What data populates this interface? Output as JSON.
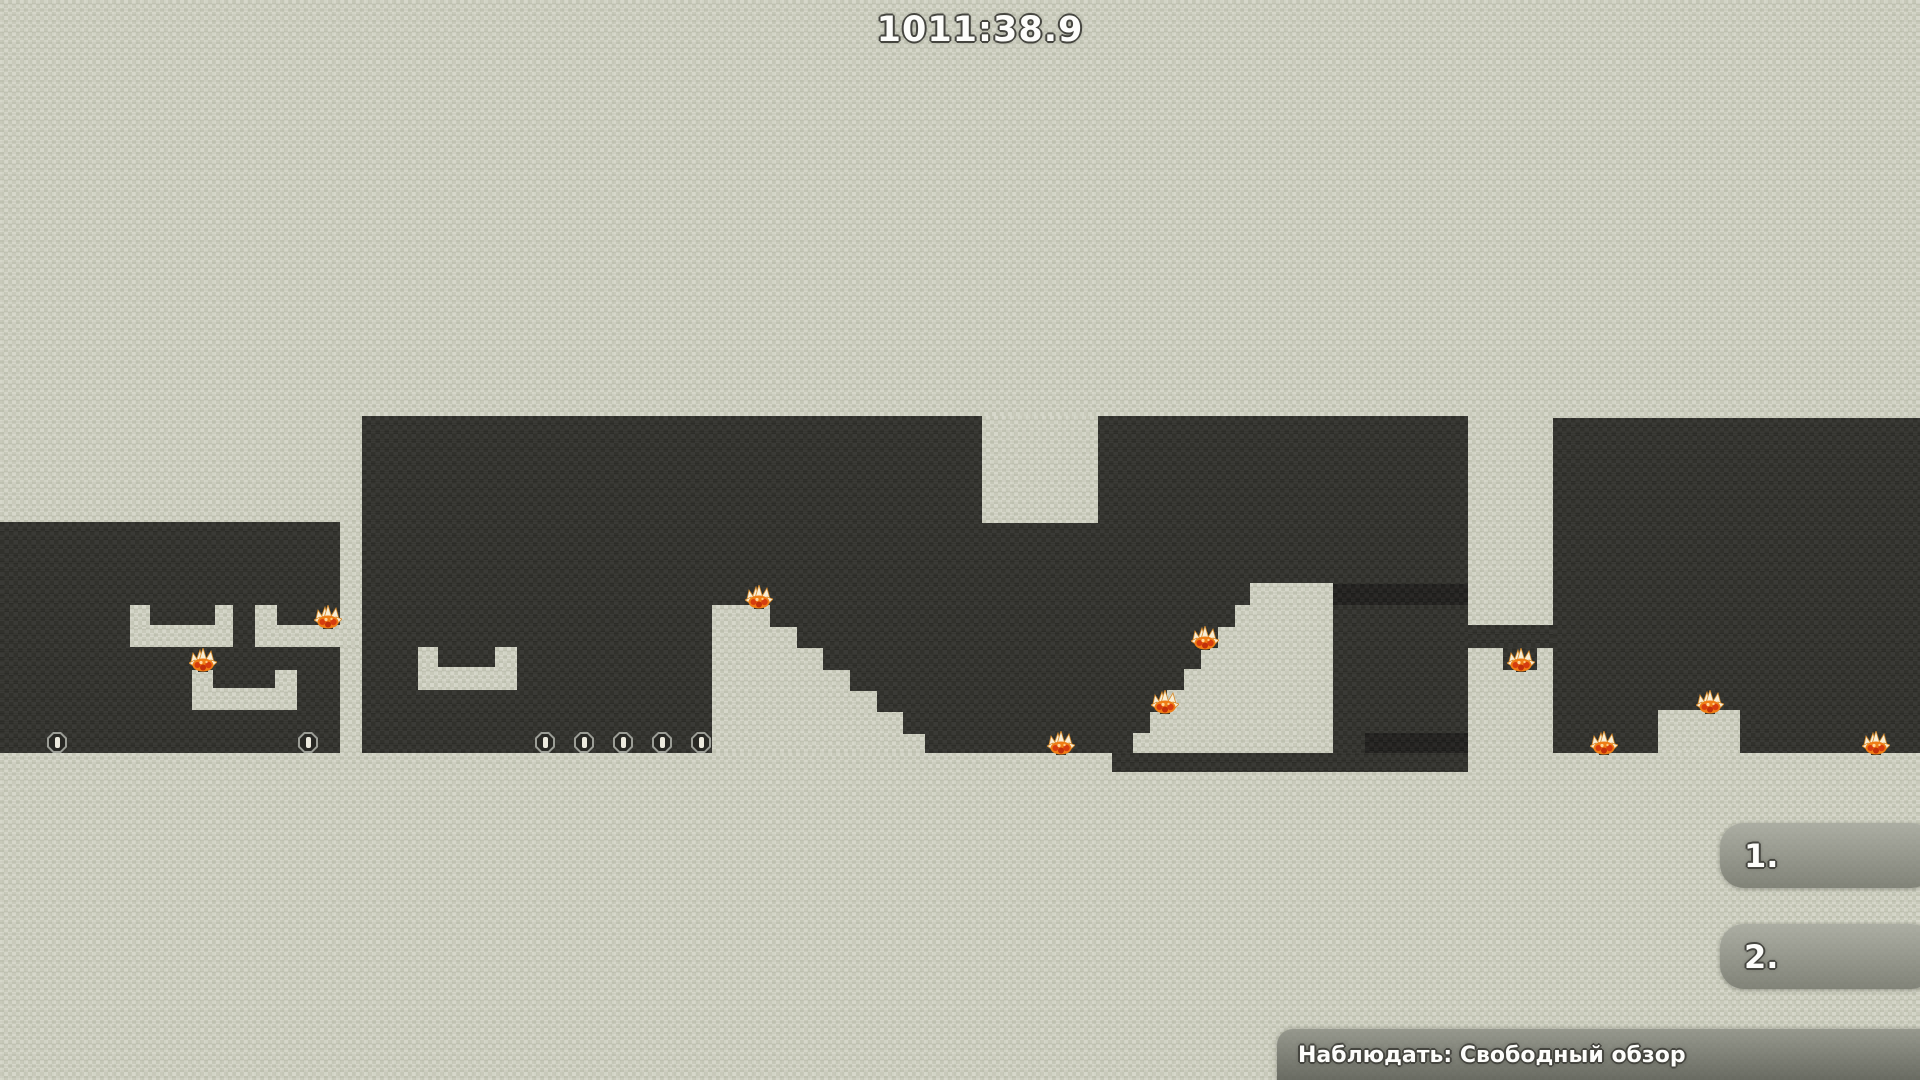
{
  "hud": {
    "timer": "1011:38.9",
    "scoreboard": [
      {
        "rank": "1."
      },
      {
        "rank": "2."
      }
    ],
    "spectate_bar": {
      "label": "Наблюдать: Свободный обзор"
    }
  },
  "colors": {
    "background": "#cdcfc0",
    "cave": "#34342f",
    "cave_deep": "#232220",
    "mine_shell": "#9c9e97",
    "mine_core": "#282824",
    "mine_slit": "#eceade",
    "hud_white": "#fdfdfb",
    "outline": "#45453f",
    "bar_top": "#a6a89ed9",
    "bar_bottom": "#74766cd9",
    "status_top": "#8d8f85d9",
    "status_bottom": "#55574fdd",
    "fire_orange": "#ef7d15",
    "fire_spike": "#f7eed6",
    "fire_red": "#d63c0e"
  },
  "game": {
    "cave_rects": [
      {
        "name": "cave-left",
        "x": 0,
        "y": 522,
        "w": 340,
        "h": 231
      },
      {
        "name": "cave-central",
        "x": 362,
        "y": 416,
        "w": 1106,
        "h": 337
      },
      {
        "name": "cave-right",
        "x": 1553,
        "y": 418,
        "w": 367,
        "h": 335
      },
      {
        "name": "pillar-tunnel",
        "x": 1468,
        "y": 625,
        "w": 85,
        "h": 23
      },
      {
        "name": "underfloor-tunnel",
        "x": 1112,
        "y": 753,
        "w": 356,
        "h": 19
      },
      {
        "name": "pillar-fire-pit",
        "x": 1503,
        "y": 648,
        "w": 34,
        "h": 22
      },
      {
        "name": "deep-band-upper",
        "x": 1333,
        "y": 584,
        "w": 135,
        "h": 21,
        "deep": true
      },
      {
        "name": "deep-band-lower",
        "x": 1365,
        "y": 733,
        "w": 103,
        "h": 20,
        "deep": true
      }
    ],
    "solid_rects": [
      {
        "name": "u1-bar",
        "x": 130,
        "y": 625,
        "w": 103,
        "h": 22
      },
      {
        "name": "u1-leg-l",
        "x": 130,
        "y": 605,
        "w": 20,
        "h": 22
      },
      {
        "name": "u1-leg-r",
        "x": 215,
        "y": 605,
        "w": 18,
        "h": 22
      },
      {
        "name": "u2-bar",
        "x": 255,
        "y": 625,
        "w": 107,
        "h": 22
      },
      {
        "name": "u2-leg-l",
        "x": 255,
        "y": 605,
        "w": 22,
        "h": 22
      },
      {
        "name": "u3-bar",
        "x": 192,
        "y": 688,
        "w": 105,
        "h": 22
      },
      {
        "name": "u3-leg-l",
        "x": 192,
        "y": 670,
        "w": 21,
        "h": 20
      },
      {
        "name": "u3-leg-r",
        "x": 275,
        "y": 670,
        "w": 22,
        "h": 20
      },
      {
        "name": "u4-bar",
        "x": 418,
        "y": 667,
        "w": 99,
        "h": 23
      },
      {
        "name": "u4-leg-l",
        "x": 418,
        "y": 647,
        "w": 20,
        "h": 22
      },
      {
        "name": "u4-leg-r",
        "x": 495,
        "y": 647,
        "w": 22,
        "h": 22
      },
      {
        "name": "ceiling-block",
        "x": 982,
        "y": 416,
        "w": 116,
        "h": 107
      },
      {
        "name": "floor-block",
        "x": 1658,
        "y": 710,
        "w": 82,
        "h": 43
      }
    ],
    "solid_polys": [
      {
        "name": "stepped-hill",
        "points": [
          [
            712,
            605
          ],
          [
            770,
            605
          ],
          [
            770,
            627
          ],
          [
            797,
            627
          ],
          [
            797,
            648
          ],
          [
            823,
            648
          ],
          [
            823,
            670
          ],
          [
            850,
            670
          ],
          [
            850,
            691
          ],
          [
            877,
            691
          ],
          [
            877,
            712
          ],
          [
            903,
            712
          ],
          [
            903,
            734
          ],
          [
            925,
            734
          ],
          [
            925,
            753
          ],
          [
            712,
            753
          ]
        ]
      },
      {
        "name": "stepped-plateau",
        "points": [
          [
            1133,
            753
          ],
          [
            1133,
            733
          ],
          [
            1150,
            733
          ],
          [
            1150,
            712
          ],
          [
            1167,
            712
          ],
          [
            1167,
            690
          ],
          [
            1184,
            690
          ],
          [
            1184,
            669
          ],
          [
            1201,
            669
          ],
          [
            1201,
            648
          ],
          [
            1218,
            648
          ],
          [
            1218,
            627
          ],
          [
            1235,
            627
          ],
          [
            1235,
            605
          ],
          [
            1250,
            605
          ],
          [
            1250,
            583
          ],
          [
            1333,
            583
          ],
          [
            1333,
            753
          ]
        ]
      }
    ],
    "mines": [
      {
        "x": 57,
        "base": 753
      },
      {
        "x": 308,
        "base": 753
      },
      {
        "x": 545,
        "base": 753
      },
      {
        "x": 584,
        "base": 753
      },
      {
        "x": 623,
        "base": 753
      },
      {
        "x": 662,
        "base": 753
      },
      {
        "x": 701,
        "base": 753
      }
    ],
    "fires": [
      {
        "x": 328,
        "base": 627
      },
      {
        "x": 203,
        "base": 670
      },
      {
        "x": 759,
        "base": 607
      },
      {
        "x": 1061,
        "base": 753
      },
      {
        "x": 1165,
        "base": 712
      },
      {
        "x": 1205,
        "base": 648
      },
      {
        "x": 1521,
        "base": 670
      },
      {
        "x": 1604,
        "base": 753
      },
      {
        "x": 1710,
        "base": 712
      },
      {
        "x": 1876,
        "base": 753
      }
    ]
  }
}
